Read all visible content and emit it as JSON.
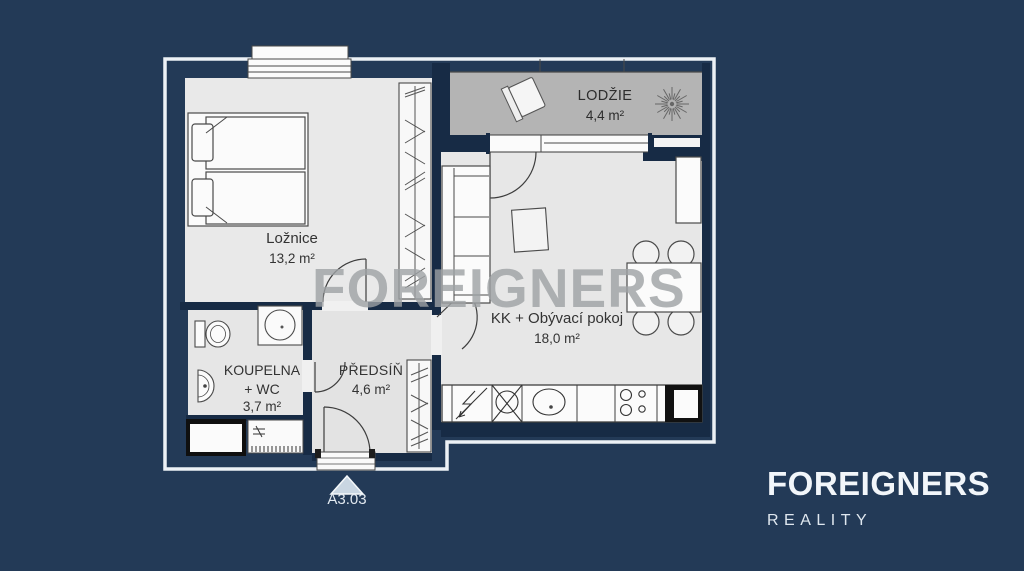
{
  "plan": {
    "unit_label": "A3.03",
    "rooms": [
      {
        "id": "loznice",
        "name": "Ložnice",
        "area": "13,2 m²"
      },
      {
        "id": "lodzie",
        "name": "LODŽIE",
        "area": "4,4 m²"
      },
      {
        "id": "living",
        "name": "KK + Obývací pokoj",
        "area": "18,0 m²"
      },
      {
        "id": "koupelna",
        "name": "KOUPELNA",
        "name_line2": "+ WC",
        "area": "3,7 m²"
      },
      {
        "id": "predsin",
        "name": "PŘEDSÍŇ",
        "area": "4,6 m²"
      }
    ]
  },
  "watermark": {
    "text": "FOREIGNERS"
  },
  "logo": {
    "brand": "FOREIGNERS",
    "subtitle": "REALITY"
  },
  "colors": {
    "background": "#233A57",
    "wall": "#172B45",
    "room_fill": "#E8E8E8",
    "loggia_fill": "#B4B4B4",
    "outline": "#EDF1F6",
    "furniture_stroke": "#4a4a4a",
    "label_text": "#333333",
    "light_text": "#E8EEF4",
    "watermark_gray": "#9EA1A4",
    "entry_triangle": "#C9D6E2"
  }
}
